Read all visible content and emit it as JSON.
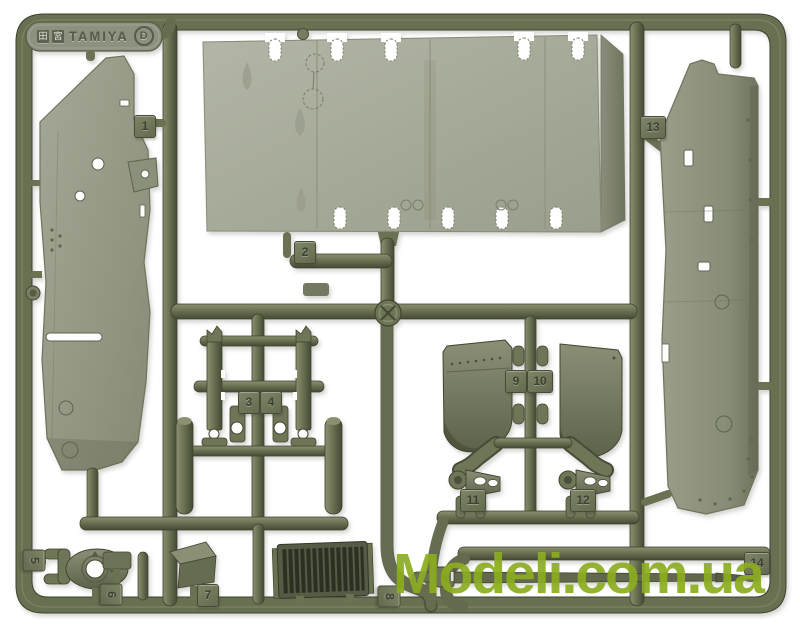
{
  "meta": {
    "subject": "Olive-green plastic model kit parts sprue (runner D) photographed on a white background"
  },
  "brand_tag": {
    "kanji_left": "田",
    "kanji_right": "宮",
    "brand": "TAMIYA",
    "sprue_letter": "D"
  },
  "part_tags": {
    "t1": "1",
    "t2": "2",
    "t3": "3",
    "t4": "4",
    "t5": "5",
    "t6": "6",
    "t7": "7",
    "t8": "8",
    "t9": "9",
    "t10": "10",
    "t11": "11",
    "t12": "12",
    "t13": "13",
    "t14": "14"
  },
  "watermark": {
    "text": "Modeli.com.ua",
    "color": "#8cad1f"
  },
  "colors": {
    "background": "#ffffff",
    "plastic_mid": "#6b7153",
    "plastic_dark": "#454a35",
    "plastic_light": "#8a9070",
    "panel_gray": "#a6aa98",
    "tag_text": "#3c4130"
  }
}
